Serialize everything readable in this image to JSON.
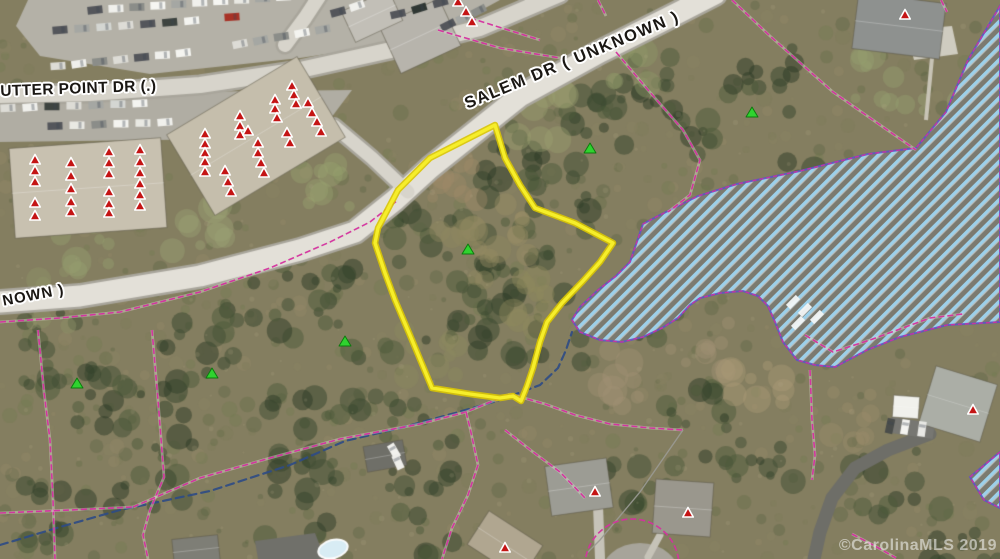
{
  "map": {
    "labels": {
      "utter_point_dr": "UTTER POINT DR (.)",
      "salem_dr": "SALEM DR ( UNKNOWN )",
      "unknown_partial": "NOWN )",
      "watermark": "©CarolinaMLS 2019"
    },
    "colors": {
      "parcel_highlight": "#f6ee2a",
      "parcel_highlight_edge": "#d9c504",
      "parcel_lines": "#d4309f",
      "lake_outline": "#5a55c5",
      "lake_hatch": "#9fd7f5",
      "creek": "#2d4b85",
      "marker_red": "#c41414",
      "marker_green": "#2fd32f"
    },
    "parcel_outline": {
      "points": [
        [
          495,
          125
        ],
        [
          505,
          158
        ],
        [
          520,
          185
        ],
        [
          535,
          208
        ],
        [
          575,
          223
        ],
        [
          613,
          243
        ],
        [
          600,
          262
        ],
        [
          583,
          281
        ],
        [
          562,
          303
        ],
        [
          547,
          322
        ],
        [
          540,
          342
        ],
        [
          533,
          368
        ],
        [
          527,
          386
        ],
        [
          521,
          401
        ],
        [
          513,
          396
        ],
        [
          500,
          398
        ],
        [
          470,
          394
        ],
        [
          432,
          388
        ],
        [
          412,
          340
        ],
        [
          395,
          300
        ],
        [
          385,
          273
        ],
        [
          375,
          243
        ],
        [
          378,
          228
        ],
        [
          398,
          190
        ],
        [
          430,
          158
        ]
      ]
    },
    "lake": {
      "points": [
        [
          1000,
          6
        ],
        [
          968,
          60
        ],
        [
          946,
          112
        ],
        [
          916,
          148
        ],
        [
          868,
          154
        ],
        [
          800,
          171
        ],
        [
          737,
          184
        ],
        [
          698,
          196
        ],
        [
          658,
          216
        ],
        [
          643,
          224
        ],
        [
          630,
          262
        ],
        [
          616,
          276
        ],
        [
          598,
          290
        ],
        [
          580,
          307
        ],
        [
          572,
          320
        ],
        [
          580,
          332
        ],
        [
          600,
          340
        ],
        [
          622,
          342
        ],
        [
          643,
          337
        ],
        [
          662,
          328
        ],
        [
          678,
          318
        ],
        [
          690,
          305
        ],
        [
          700,
          298
        ],
        [
          720,
          293
        ],
        [
          743,
          291
        ],
        [
          758,
          296
        ],
        [
          768,
          306
        ],
        [
          775,
          322
        ],
        [
          783,
          342
        ],
        [
          797,
          360
        ],
        [
          815,
          365
        ],
        [
          835,
          367
        ],
        [
          867,
          350
        ],
        [
          900,
          337
        ],
        [
          947,
          325
        ],
        [
          1000,
          322
        ]
      ],
      "cove_points": [
        [
          1000,
          452
        ],
        [
          970,
          477
        ],
        [
          984,
          500
        ],
        [
          1000,
          508
        ]
      ]
    },
    "creek": {
      "points": [
        [
          0,
          545
        ],
        [
          60,
          527
        ],
        [
          120,
          510
        ],
        [
          210,
          491
        ],
        [
          290,
          465
        ],
        [
          345,
          441
        ],
        [
          400,
          428
        ],
        [
          455,
          413
        ],
        [
          500,
          400
        ],
        [
          540,
          385
        ],
        [
          558,
          368
        ],
        [
          566,
          350
        ],
        [
          572,
          332
        ]
      ]
    },
    "parcel_lines": [
      {
        "points": [
          [
            0,
            322
          ],
          [
            60,
            318
          ],
          [
            120,
            312
          ],
          [
            200,
            292
          ],
          [
            270,
            268
          ],
          [
            330,
            242
          ],
          [
            370,
            222
          ],
          [
            398,
            200
          ]
        ]
      },
      {
        "points": [
          [
            438,
            30
          ],
          [
            500,
            48
          ],
          [
            560,
            58
          ]
        ]
      },
      {
        "points": [
          [
            470,
            18
          ],
          [
            540,
            40
          ]
        ]
      },
      {
        "points": [
          [
            732,
            0
          ],
          [
            770,
            36
          ],
          [
            833,
            92
          ],
          [
            873,
            120
          ],
          [
            916,
            150
          ]
        ]
      },
      {
        "points": [
          [
            616,
            52
          ],
          [
            648,
            90
          ],
          [
            683,
            130
          ],
          [
            700,
            160
          ],
          [
            690,
            195
          ],
          [
            668,
            212
          ]
        ]
      },
      {
        "points": [
          [
            38,
            330
          ],
          [
            44,
            392
          ],
          [
            50,
            440
          ],
          [
            53,
            500
          ],
          [
            55,
            559
          ]
        ]
      },
      {
        "points": [
          [
            152,
            330
          ],
          [
            158,
            400
          ],
          [
            164,
            477
          ],
          [
            150,
            510
          ],
          [
            143,
            535
          ],
          [
            148,
            559
          ]
        ]
      },
      {
        "points": [
          [
            0,
            513
          ],
          [
            70,
            510
          ],
          [
            133,
            507
          ]
        ]
      },
      {
        "points": [
          [
            133,
            507
          ],
          [
            200,
            478
          ],
          [
            270,
            458
          ],
          [
            340,
            439
          ],
          [
            420,
            424
          ],
          [
            466,
            412
          ],
          [
            510,
            394
          ]
        ]
      },
      {
        "points": [
          [
            510,
            394
          ],
          [
            545,
            404
          ],
          [
            575,
            415
          ],
          [
            610,
            424
          ],
          [
            650,
            428
          ],
          [
            683,
            430
          ]
        ]
      },
      {
        "points": [
          [
            466,
            412
          ],
          [
            470,
            428
          ],
          [
            478,
            465
          ],
          [
            468,
            495
          ],
          [
            452,
            528
          ],
          [
            442,
            559
          ]
        ]
      },
      {
        "points": [
          [
            505,
            430
          ],
          [
            533,
            452
          ],
          [
            560,
            472
          ],
          [
            585,
            498
          ]
        ]
      },
      {
        "points": [
          [
            805,
            335
          ],
          [
            833,
            352
          ],
          [
            870,
            340
          ],
          [
            930,
            318
          ],
          [
            963,
            314
          ]
        ]
      },
      {
        "points": [
          [
            810,
            370
          ],
          [
            812,
            420
          ],
          [
            815,
            455
          ],
          [
            812,
            480
          ]
        ]
      },
      {
        "points": [
          [
            852,
            534
          ],
          [
            875,
            546
          ],
          [
            896,
            558
          ]
        ]
      },
      {
        "points": [
          [
            941,
            0
          ],
          [
            947,
            12
          ]
        ]
      },
      {
        "points": [
          [
            598,
            0
          ],
          [
            606,
            16
          ]
        ]
      }
    ],
    "power_line": {
      "points": [
        [
          683,
          430
        ],
        [
          640,
          492
        ],
        [
          600,
          540
        ],
        [
          587,
          553
        ]
      ],
      "color": "#9a9a94"
    },
    "culdesac_arc": {
      "cx": 632,
      "cy": 566,
      "r": 47
    },
    "roads": [
      {
        "name": "salem-dr",
        "width": 21,
        "points": [
          [
            0,
            302
          ],
          [
            80,
            296
          ],
          [
            200,
            276
          ],
          [
            300,
            250
          ],
          [
            355,
            232
          ],
          [
            395,
            200
          ],
          [
            430,
            168
          ],
          [
            520,
            96
          ],
          [
            600,
            52
          ],
          [
            660,
            22
          ],
          [
            715,
            -6
          ]
        ]
      },
      {
        "name": "utter-point-dr",
        "width": 16,
        "points": [
          [
            -5,
            95
          ],
          [
            90,
            93
          ],
          [
            200,
            85
          ],
          [
            300,
            70
          ],
          [
            400,
            48
          ],
          [
            480,
            28
          ],
          [
            560,
            -6
          ]
        ]
      },
      {
        "name": "entry-spur",
        "width": 13,
        "points": [
          [
            408,
            192
          ],
          [
            372,
            158
          ],
          [
            334,
            126
          ]
        ]
      },
      {
        "name": "north-spur",
        "width": 14,
        "points": [
          [
            285,
            45
          ],
          [
            305,
            18
          ],
          [
            322,
            -8
          ]
        ]
      }
    ],
    "markers": {
      "red": [
        [
          35,
          160
        ],
        [
          35,
          171
        ],
        [
          35,
          182
        ],
        [
          35,
          203
        ],
        [
          35,
          216
        ],
        [
          71,
          163
        ],
        [
          71,
          176
        ],
        [
          71,
          189
        ],
        [
          71,
          202
        ],
        [
          71,
          212
        ],
        [
          109,
          152
        ],
        [
          109,
          163
        ],
        [
          109,
          174
        ],
        [
          109,
          192
        ],
        [
          109,
          204
        ],
        [
          109,
          213
        ],
        [
          140,
          150
        ],
        [
          140,
          162
        ],
        [
          140,
          173
        ],
        [
          140,
          184
        ],
        [
          140,
          195
        ],
        [
          140,
          206
        ],
        [
          205,
          134
        ],
        [
          205,
          144
        ],
        [
          205,
          153
        ],
        [
          205,
          162
        ],
        [
          205,
          172
        ],
        [
          225,
          171
        ],
        [
          228,
          182
        ],
        [
          231,
          192
        ],
        [
          240,
          116
        ],
        [
          240,
          126
        ],
        [
          240,
          135
        ],
        [
          248,
          131
        ],
        [
          258,
          143
        ],
        [
          258,
          153
        ],
        [
          261,
          163
        ],
        [
          264,
          173
        ],
        [
          275,
          100
        ],
        [
          275,
          109
        ],
        [
          277,
          118
        ],
        [
          292,
          86
        ],
        [
          294,
          95
        ],
        [
          296,
          104
        ],
        [
          308,
          103
        ],
        [
          312,
          113
        ],
        [
          317,
          122
        ],
        [
          321,
          132
        ],
        [
          287,
          133
        ],
        [
          290,
          143
        ],
        [
          458,
          2
        ],
        [
          466,
          12
        ],
        [
          472,
          22
        ],
        [
          905,
          15
        ],
        [
          973,
          410
        ],
        [
          595,
          492
        ],
        [
          688,
          513
        ],
        [
          505,
          548
        ]
      ],
      "green": [
        [
          468,
          249
        ],
        [
          590,
          148
        ],
        [
          752,
          112
        ],
        [
          345,
          341
        ],
        [
          77,
          383
        ],
        [
          212,
          373
        ]
      ]
    },
    "boats": [
      [
        793,
        302
      ],
      [
        805,
        310
      ],
      [
        817,
        317
      ],
      [
        798,
        323
      ]
    ]
  }
}
